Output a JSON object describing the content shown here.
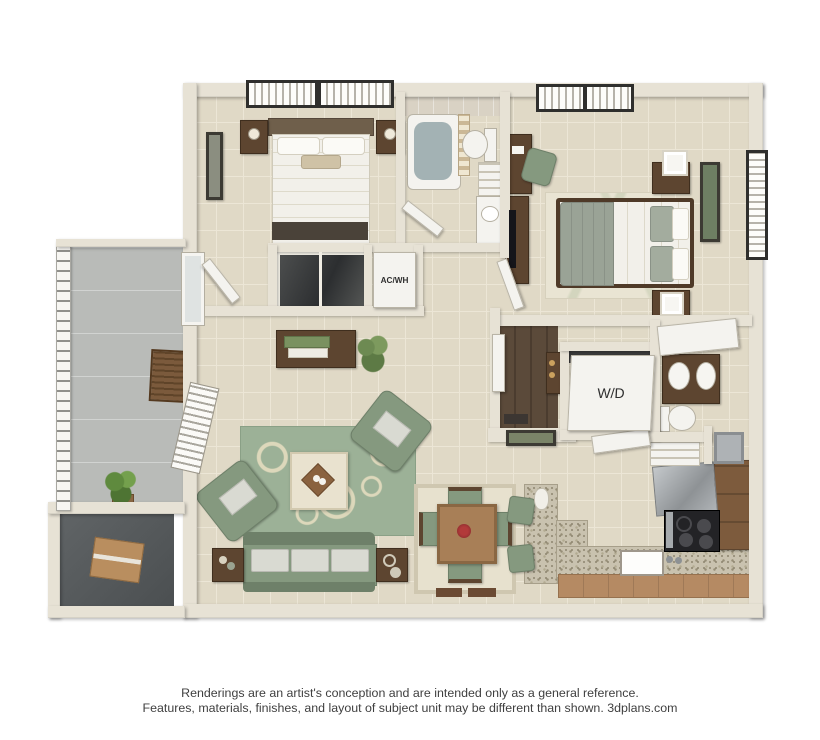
{
  "floorplan": {
    "labels": {
      "utility_closet": "AC/WH",
      "laundry_closet": "W/D"
    },
    "scene": {
      "type": "3d-apartment-floor-plan-rendering",
      "rooms": [
        "bedroom-1",
        "bathroom-1",
        "hallway",
        "master-bedroom",
        "bathroom-2",
        "laundry-closet",
        "utility-closet",
        "entry-foyer",
        "living-room",
        "dining-area",
        "kitchen",
        "balcony",
        "storage-closet"
      ],
      "furniture": [
        "bed",
        "nightstands",
        "wall-art",
        "closet-mirror-doors",
        "tv-console",
        "bathtub",
        "toilet",
        "vanity",
        "desk",
        "desk-chair",
        "tv-dresser",
        "area-rug",
        "coffee-table",
        "armchairs",
        "sofa",
        "side-tables",
        "dining-table",
        "dining-chairs",
        "breakfast-bar",
        "bar-stools",
        "refrigerator",
        "stove",
        "kitchen-sink",
        "cabinets",
        "patio-chair",
        "potted-plant",
        "storage-box",
        "console-table"
      ]
    }
  },
  "footer": {
    "line1": "Renderings are an artist's conception and are intended only as a general reference.",
    "line2": "Features, materials, finishes, and layout of subject unit may be different than shown. 3dplans.com"
  },
  "colors": {
    "wall": "#e7e2d5",
    "wall_shadow": "#c9c2b1",
    "tile_floor": "#e0d9c6",
    "tile_grout": "#ece6d6",
    "bath_tile": "#d9d2c4",
    "balcony_concrete": "#b9bbb8",
    "storage_floor": "#565a5c",
    "foyer_wood": "#564637",
    "sofa_green": "#85997f",
    "sofa_green_dark": "#6e8069",
    "cushion_white": "#d9dad2",
    "rug_green": "#9cb197",
    "rug_cream": "#ddd8bb",
    "master_comforter": "#9aa396",
    "bed_white": "#f2f0ea",
    "wood_dark": "#5d4530",
    "wood_mid": "#7d5b3d",
    "wood_light": "#b58a63",
    "granite": "#c9c2af",
    "granite_speck": "#968e77",
    "stainless": "#a6aaad",
    "appliance_black": "#232326",
    "fixture_white": "#f4f3ef",
    "window_frame": "#2f2f2d",
    "water_blue": "#a3b2b4",
    "label_text": "#2e2e2e",
    "footer_text": "#3f3f3f",
    "page_bg": "#ffffff"
  }
}
